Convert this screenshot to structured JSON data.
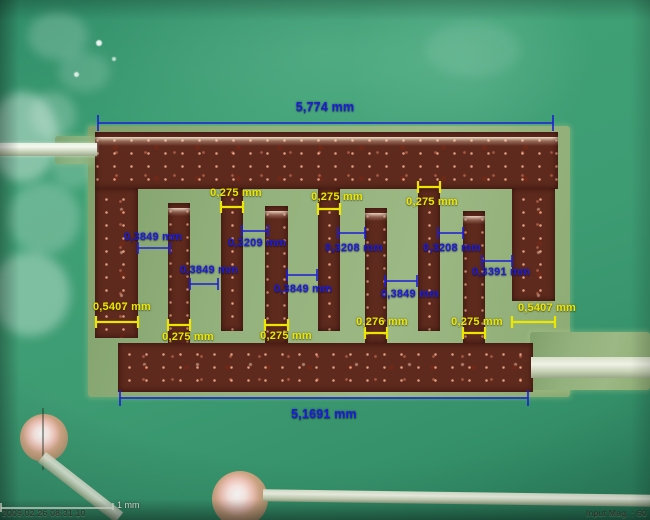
{
  "measurements": {
    "blue_color": "#1d1dd8",
    "yellow_color": "#ede600",
    "blue": [
      "5,774 mm",
      "0,3849 mm",
      "0,3209 mm",
      "0,3208 mm",
      "0,3208 mm",
      "0,3849 mm",
      "0,3849 mm",
      "0,3849 mm",
      "0,3391 mm",
      "5,1691 mm"
    ],
    "yellow": [
      "0,275 mm",
      "0,275 mm",
      "0,275 mm",
      "0,5407 mm",
      "0,5407 mm",
      "0,275 mm",
      "0,275 mm",
      "0,276 mm",
      "0,275 mm"
    ]
  },
  "status_bar": {
    "timestamp": "2009.02.26 08:31:10",
    "scale_label": "1 mm",
    "magnification_label": "Input Mag. : 60"
  }
}
